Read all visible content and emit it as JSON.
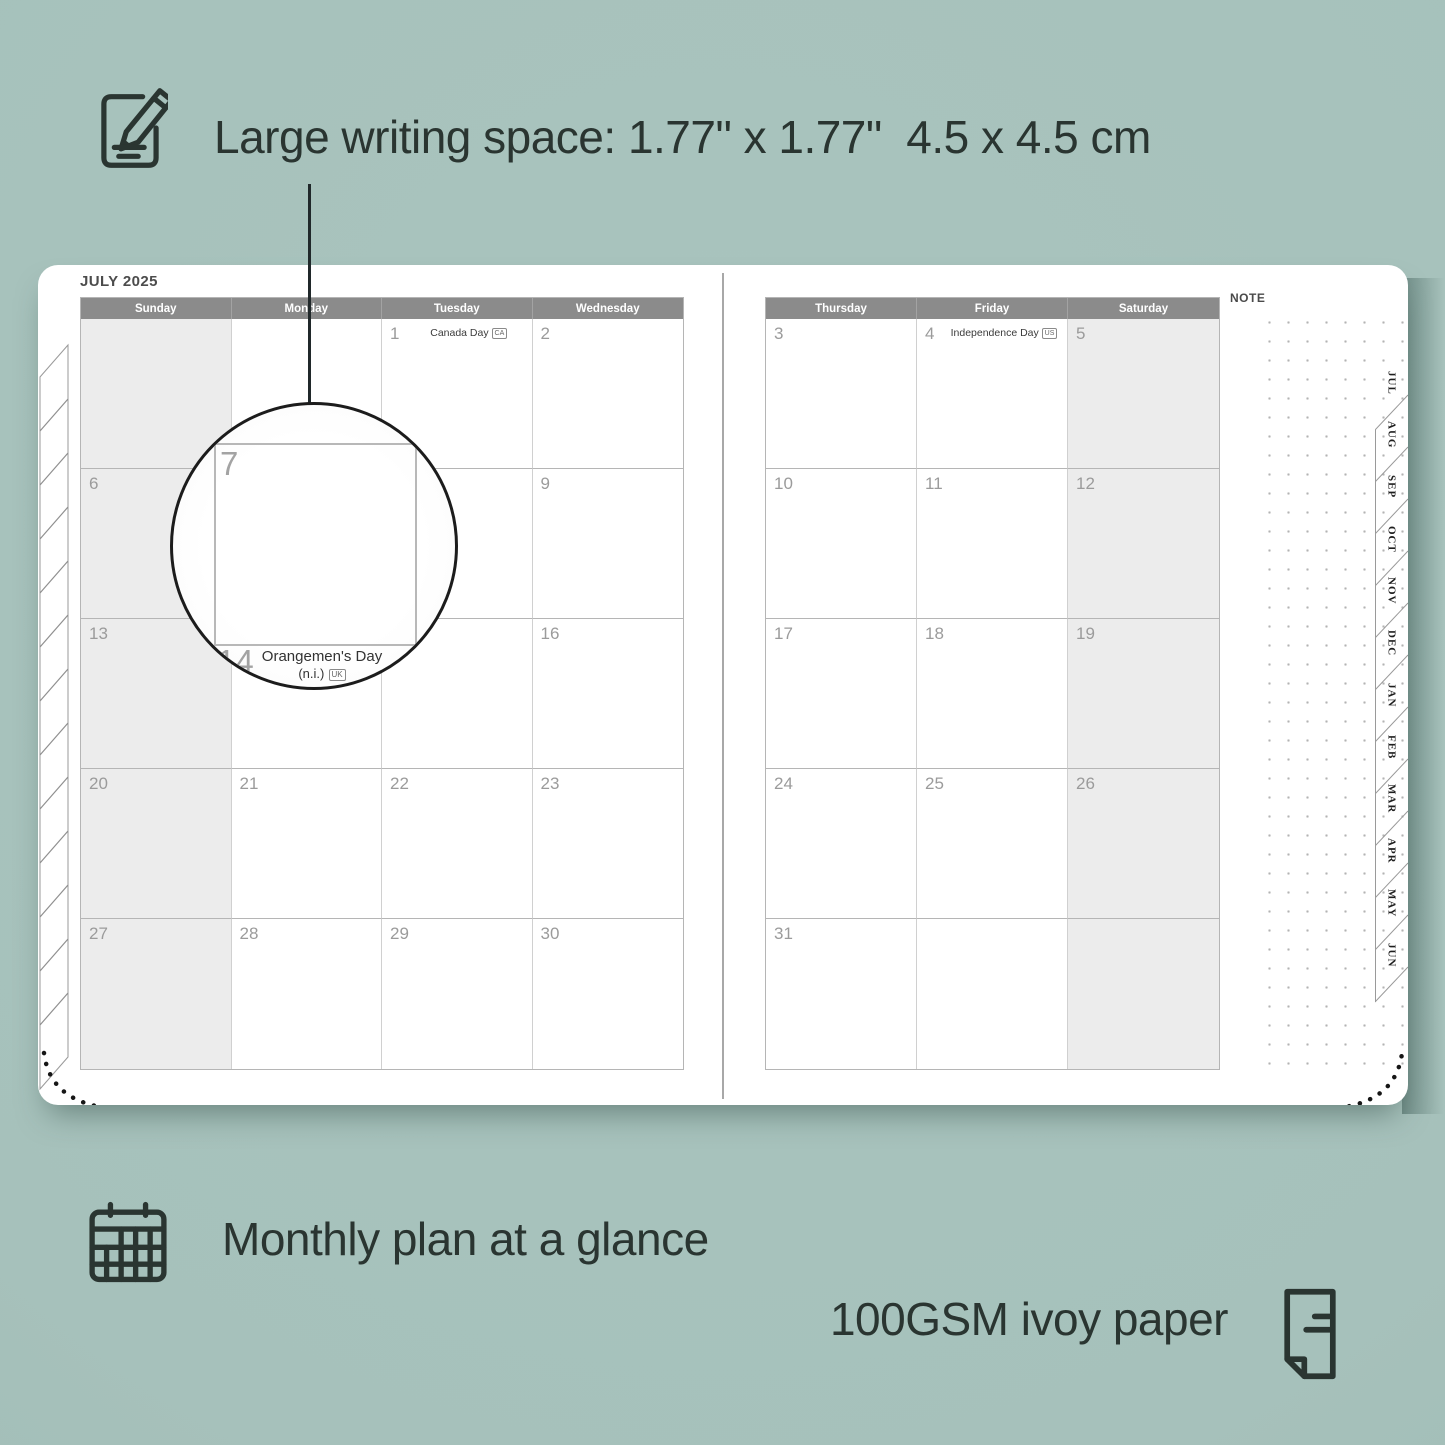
{
  "colors": {
    "background": "#a6c1bb",
    "ink": "#2a3531",
    "header_bar": "#8b8b8b",
    "weekend_fill": "#ececec",
    "date_text": "#9b9b9b",
    "grid_line": "#b5b5b5"
  },
  "annotations": {
    "top": "Large writing space: 1.77\" x 1.77\"  4.5 x 4.5 cm",
    "bottom_left": "Monthly plan at a glance",
    "bottom_right": "100GSM ivoy paper"
  },
  "planner": {
    "title": "JULY 2025",
    "note_label": "NOTE",
    "left_headers": [
      "Sunday",
      "Monday",
      "Tuesday",
      "Wednesday"
    ],
    "right_headers": [
      "Thursday",
      "Friday",
      "Saturday"
    ],
    "left_cells": [
      [
        null,
        null,
        {
          "d": "1",
          "h": "Canada Day",
          "b": "CA"
        },
        {
          "d": "2"
        }
      ],
      [
        {
          "d": "6"
        },
        {
          "d": "7"
        },
        {
          "d": "8"
        },
        {
          "d": "9"
        }
      ],
      [
        {
          "d": "13"
        },
        {
          "d": "14",
          "h": "Orangemen's Day (n.i.)",
          "b": "UK"
        },
        {
          "d": "15"
        },
        {
          "d": "16"
        }
      ],
      [
        {
          "d": "20"
        },
        {
          "d": "21"
        },
        {
          "d": "22"
        },
        {
          "d": "23"
        }
      ],
      [
        {
          "d": "27"
        },
        {
          "d": "28"
        },
        {
          "d": "29"
        },
        {
          "d": "30"
        }
      ]
    ],
    "right_cells": [
      [
        {
          "d": "3"
        },
        {
          "d": "4",
          "h": "Independence Day",
          "b": "US"
        },
        {
          "d": "5"
        }
      ],
      [
        {
          "d": "10"
        },
        {
          "d": "11"
        },
        {
          "d": "12"
        }
      ],
      [
        {
          "d": "17"
        },
        {
          "d": "18"
        },
        {
          "d": "19"
        }
      ],
      [
        {
          "d": "24"
        },
        {
          "d": "25"
        },
        {
          "d": "26"
        }
      ],
      [
        {
          "d": "31"
        },
        null,
        null
      ]
    ],
    "tabs": [
      "JUL",
      "AUG",
      "SEP",
      "OCT",
      "NOV",
      "DEC",
      "JAN",
      "FEB",
      "MAR",
      "APR",
      "MAY",
      "JUN"
    ],
    "magnifier": {
      "day": "7",
      "overlap_day": "14",
      "holiday_line1": "Orangemen's Day",
      "holiday_line2": "(n.i.)",
      "badge": "UK"
    }
  }
}
